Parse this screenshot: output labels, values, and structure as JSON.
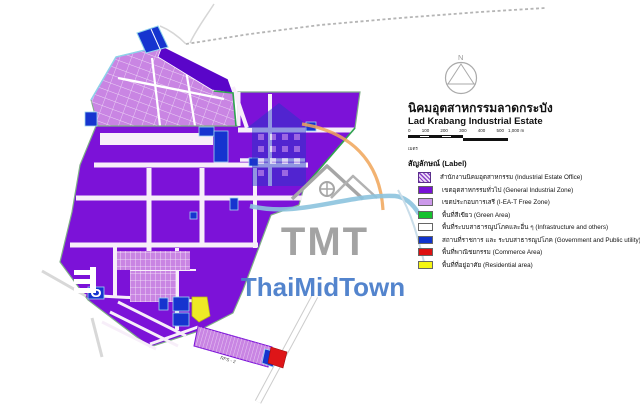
{
  "title": {
    "thai": "นิคมอุตสาหกรรมลาดกระบัง",
    "english": "Lad Krabang Industrial Estate"
  },
  "compass": {
    "north_label": "N"
  },
  "scale_bar": {
    "tick_labels": [
      "0",
      "100",
      "200",
      "300",
      "400",
      "500"
    ],
    "end_label": "1,000 m",
    "unit_label": "เมตร"
  },
  "legend": {
    "heading": "สัญลักษณ์ (Label)",
    "items": [
      {
        "id": "office",
        "swatch": "office-icon",
        "color": "#8a3fc8",
        "label": "สำนักงานนิคมอุตสาหกรรม (Industrial Estate Office)"
      },
      {
        "id": "general",
        "swatch": "fill",
        "color": "#7710d6",
        "label": "เขตอุตสาหกรรมทั่วไป (General Industrial Zone)"
      },
      {
        "id": "free-zone",
        "swatch": "fill",
        "color": "#cc99ea",
        "label": "เขตประกอบการเสรี (I-EA-T Free Zone)"
      },
      {
        "id": "green",
        "swatch": "fill",
        "color": "#16c12e",
        "label": "พื้นที่สีเขียว (Green Area)"
      },
      {
        "id": "infra",
        "swatch": "fill",
        "color": "#ffffff",
        "label": "พื้นที่ระบบสาธารณูปโภคและอื่น ๆ (Infrastructure and others)"
      },
      {
        "id": "government",
        "swatch": "fill",
        "color": "#1133cc",
        "label": "สถานที่ราชการ และ ระบบสาธารณูปโภค (Government and Public utility)"
      },
      {
        "id": "commerce",
        "swatch": "fill",
        "color": "#dd1111",
        "label": "พื้นที่พาณิชยกรรม (Commerce Area)"
      },
      {
        "id": "residential",
        "swatch": "fill",
        "color": "#f5f513",
        "label": "พื้นที่ที่อยู่อาศัย (Residential area)"
      }
    ]
  },
  "watermark": {
    "acronym": "TMT",
    "name": "ThaiMidTown"
  },
  "map": {
    "labels": [
      {
        "text": "RPS - 2"
      }
    ]
  },
  "colors": {
    "general": "#7c12d8",
    "violet": "#5a05c9",
    "free": "#c985e3",
    "gov": "#1634cf",
    "green": "#2fa44f",
    "commerce": "#de1518",
    "residential": "#eeea25",
    "road": "#f7eef9",
    "boundary": "#7fae87",
    "cyan": "#8ed2ea",
    "wmgray": "#9c9c9c",
    "wmblue": "#4a7ecb",
    "wmbuilding": "#2438c8",
    "wmswoosh": "#8cc3de",
    "wmarc": "#f0a558",
    "wmroof": "#a6a6a6"
  }
}
